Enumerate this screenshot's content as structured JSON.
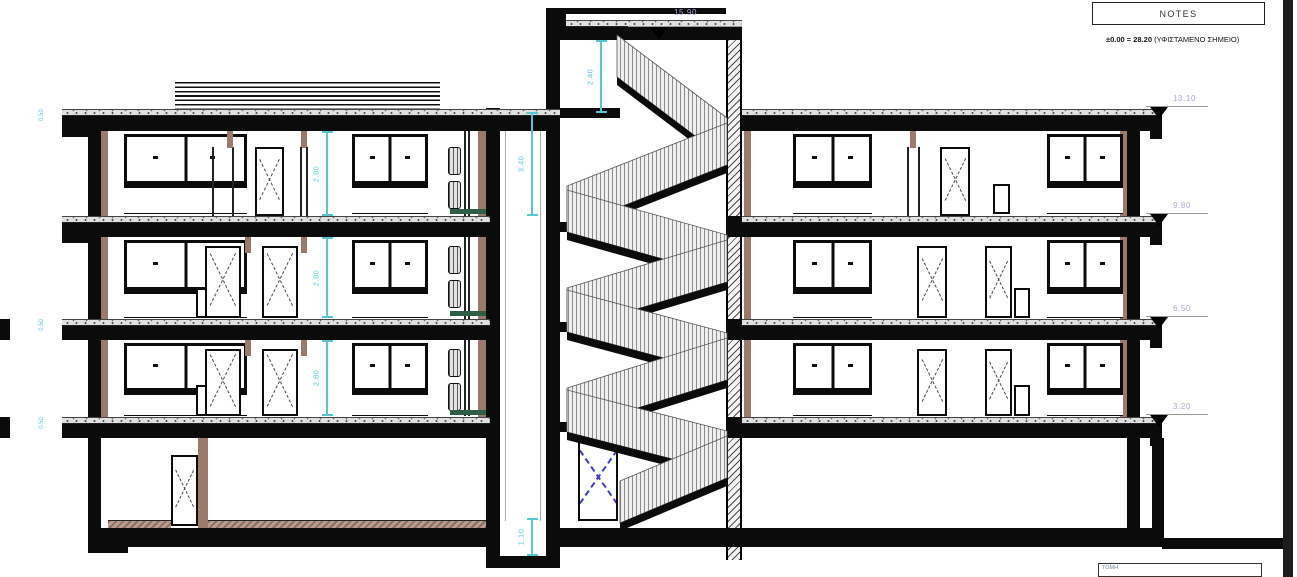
{
  "notes": {
    "title": "NOTES",
    "benchmark_value": "±0.00 = 28.20",
    "benchmark_suffix": "(ΥΦΙΣΤΑΜΕΝΟ ΣΗΜΕΙΟ)"
  },
  "elevations": {
    "tower_roof": "15.90",
    "roof": "13.10",
    "third_floor": "9.80",
    "second_floor": "6.50",
    "first_floor": "3.20"
  },
  "dimensions": {
    "tower_parapet": "2.40",
    "shaft_top_floor": "3.40",
    "elevator_pit": "1.10",
    "floor3_clear": "2.80",
    "floor2_clear": "2.80",
    "floor1_clear": "2.80",
    "slab_edge_roof": "0.50",
    "slab_edge_mid": "0.50",
    "slab_edge_low": "0.50"
  },
  "title_block": {
    "label": "ΤΟΜΗ"
  },
  "colors": {
    "dimension_cyan": "#55c6d6",
    "elevation_purple": "#b3a6d9",
    "wall_brown": "#9b7a6e",
    "shelf_green": "#2f5d45",
    "ink": "#0b0b0b"
  }
}
